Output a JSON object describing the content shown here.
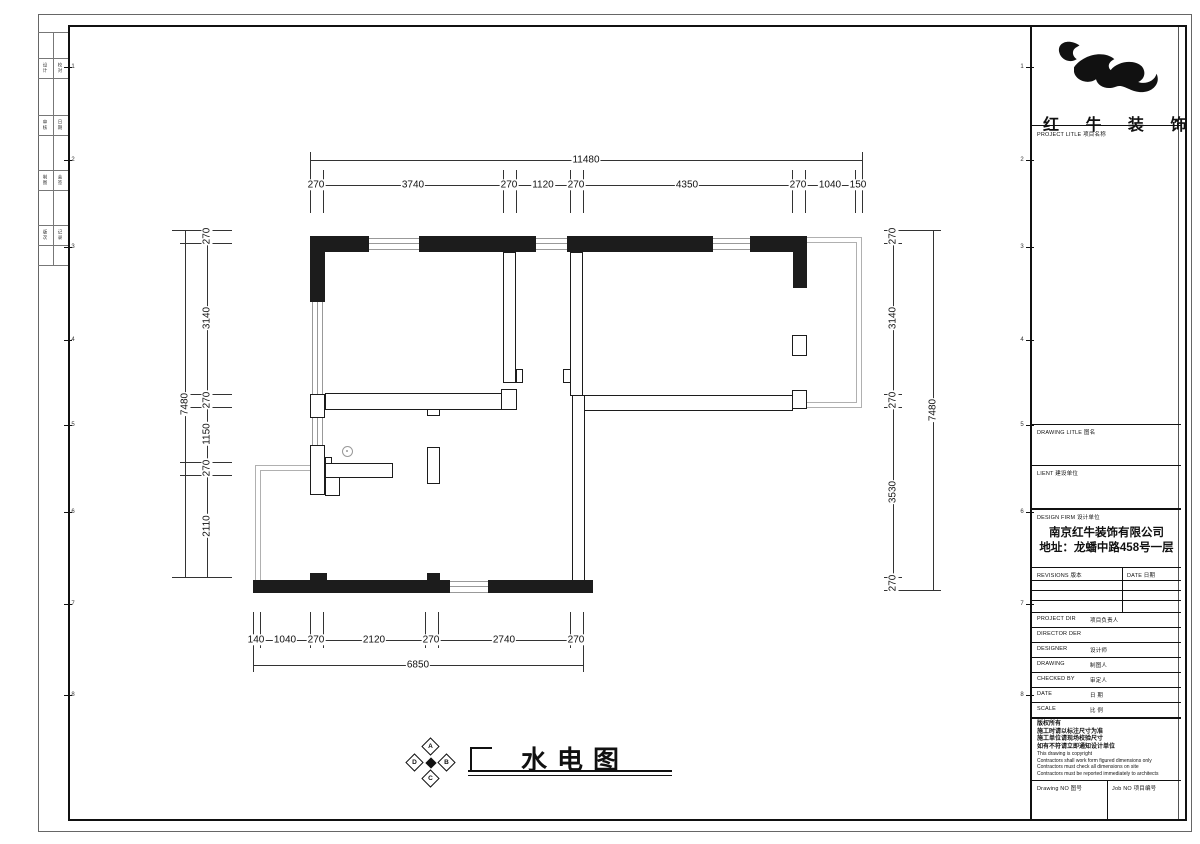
{
  "title_block": {
    "brand": "红 牛 装 饰",
    "project_title_label": "PROJECT LITLE  项目名称",
    "drawing_title_label": "DRAWING LITLE  图名",
    "client_label": "LIENT  建设单位",
    "design_firm_label": "DESIGN FIRM  设计单位",
    "company_name": "南京红牛装饰有限公司",
    "company_address": "地址：龙蟠中路458号一层",
    "revisions_label": "REVISIONS 版本",
    "revisions_date_label": "DATE 日期",
    "rows": [
      {
        "en": "PROJECT DIR",
        "zh": "项目负责人"
      },
      {
        "en": "DIRECTOR DER",
        "zh": ""
      },
      {
        "en": "DESIGNER",
        "zh": "设计师"
      },
      {
        "en": "DRAWING",
        "zh": "制图人"
      },
      {
        "en": "CHECKED BY",
        "zh": "审定人"
      },
      {
        "en": "DATE",
        "zh": "日 期"
      },
      {
        "en": "SCALE",
        "zh": "比 例"
      }
    ],
    "copyright_lines": [
      "版权所有",
      "施工时请以标注尺寸为准",
      "施工单位请现场校验尺寸",
      "如有不符请立即通知设计单位",
      "This drawing is copyright",
      "Contractors shall work form figured dimensions only",
      "Contractors must check all dimensions on site",
      "Contractors must be reported immediately to architects"
    ],
    "drawing_no_label": "Drawing NO  图号",
    "job_no_label": "Job NO  项目编号"
  },
  "drawing": {
    "title": "水电图",
    "compass": {
      "top": "A",
      "left": "D",
      "right": "B",
      "bottom": "C"
    }
  },
  "dims": {
    "top": {
      "overall": "11480",
      "segments": [
        "270",
        "3740",
        "270",
        "1120",
        "270",
        "4350",
        "270",
        "1040",
        "150"
      ]
    },
    "bottom": {
      "overall": "6850",
      "segments": [
        "140",
        "1040",
        "270",
        "2120",
        "270",
        "2740",
        "270"
      ]
    },
    "left": {
      "overall": "7480",
      "segments": [
        "270",
        "3140",
        "270",
        "1150",
        "270",
        "2110"
      ]
    },
    "right": {
      "overall": "7480",
      "segments": [
        "270",
        "3140",
        "270",
        "3530",
        "270"
      ]
    }
  },
  "frame": {
    "ref_numbers": [
      "1",
      "2",
      "3",
      "4",
      "5",
      "6",
      "7",
      "8"
    ],
    "strip_rows": [
      [
        "设计",
        "校对"
      ],
      [
        "审核",
        "日期"
      ],
      [
        "制图",
        "会签"
      ],
      [
        "版次",
        "记录"
      ]
    ]
  }
}
